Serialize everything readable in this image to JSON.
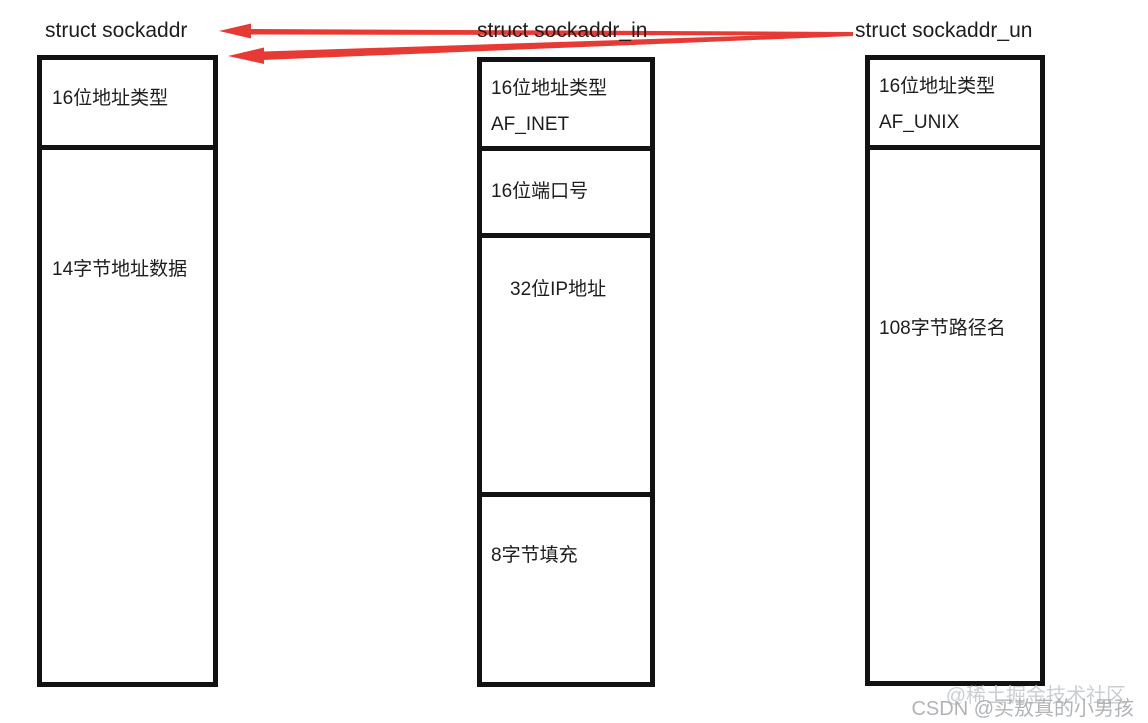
{
  "diagram": {
    "description_note": "memory layout comparison of socket address structures",
    "columns": [
      {
        "title": "struct sockaddr",
        "sections": [
          {
            "label": "16位地址类型"
          },
          {
            "label": "14字节地址数据"
          }
        ]
      },
      {
        "title": "struct sockaddr_in",
        "sections": [
          {
            "label": "16位地址类型",
            "sublabel": "AF_INET"
          },
          {
            "label": "16位端口号"
          },
          {
            "label": "32位IP地址"
          },
          {
            "label": "8字节填充"
          }
        ]
      },
      {
        "title": "struct sockaddr_un",
        "sections": [
          {
            "label": "16位地址类型",
            "sublabel": "AF_UNIX"
          },
          {
            "label": "108字节路径名"
          }
        ]
      }
    ],
    "relations": [
      {
        "from": "struct sockaddr_un",
        "to": "struct sockaddr",
        "style": "thin red arrow"
      },
      {
        "from": "struct sockaddr_in",
        "to": "struct sockaddr",
        "style": "thick red arrow"
      }
    ]
  },
  "watermarks": {
    "juejin": "@稀土掘金技术社区",
    "csdn": "CSDN @买敖真的小男孩"
  },
  "colors": {
    "arrow_red": "#e83a34",
    "box_border": "#121212",
    "text": "#1d1d1d",
    "background": "#ffffff"
  }
}
